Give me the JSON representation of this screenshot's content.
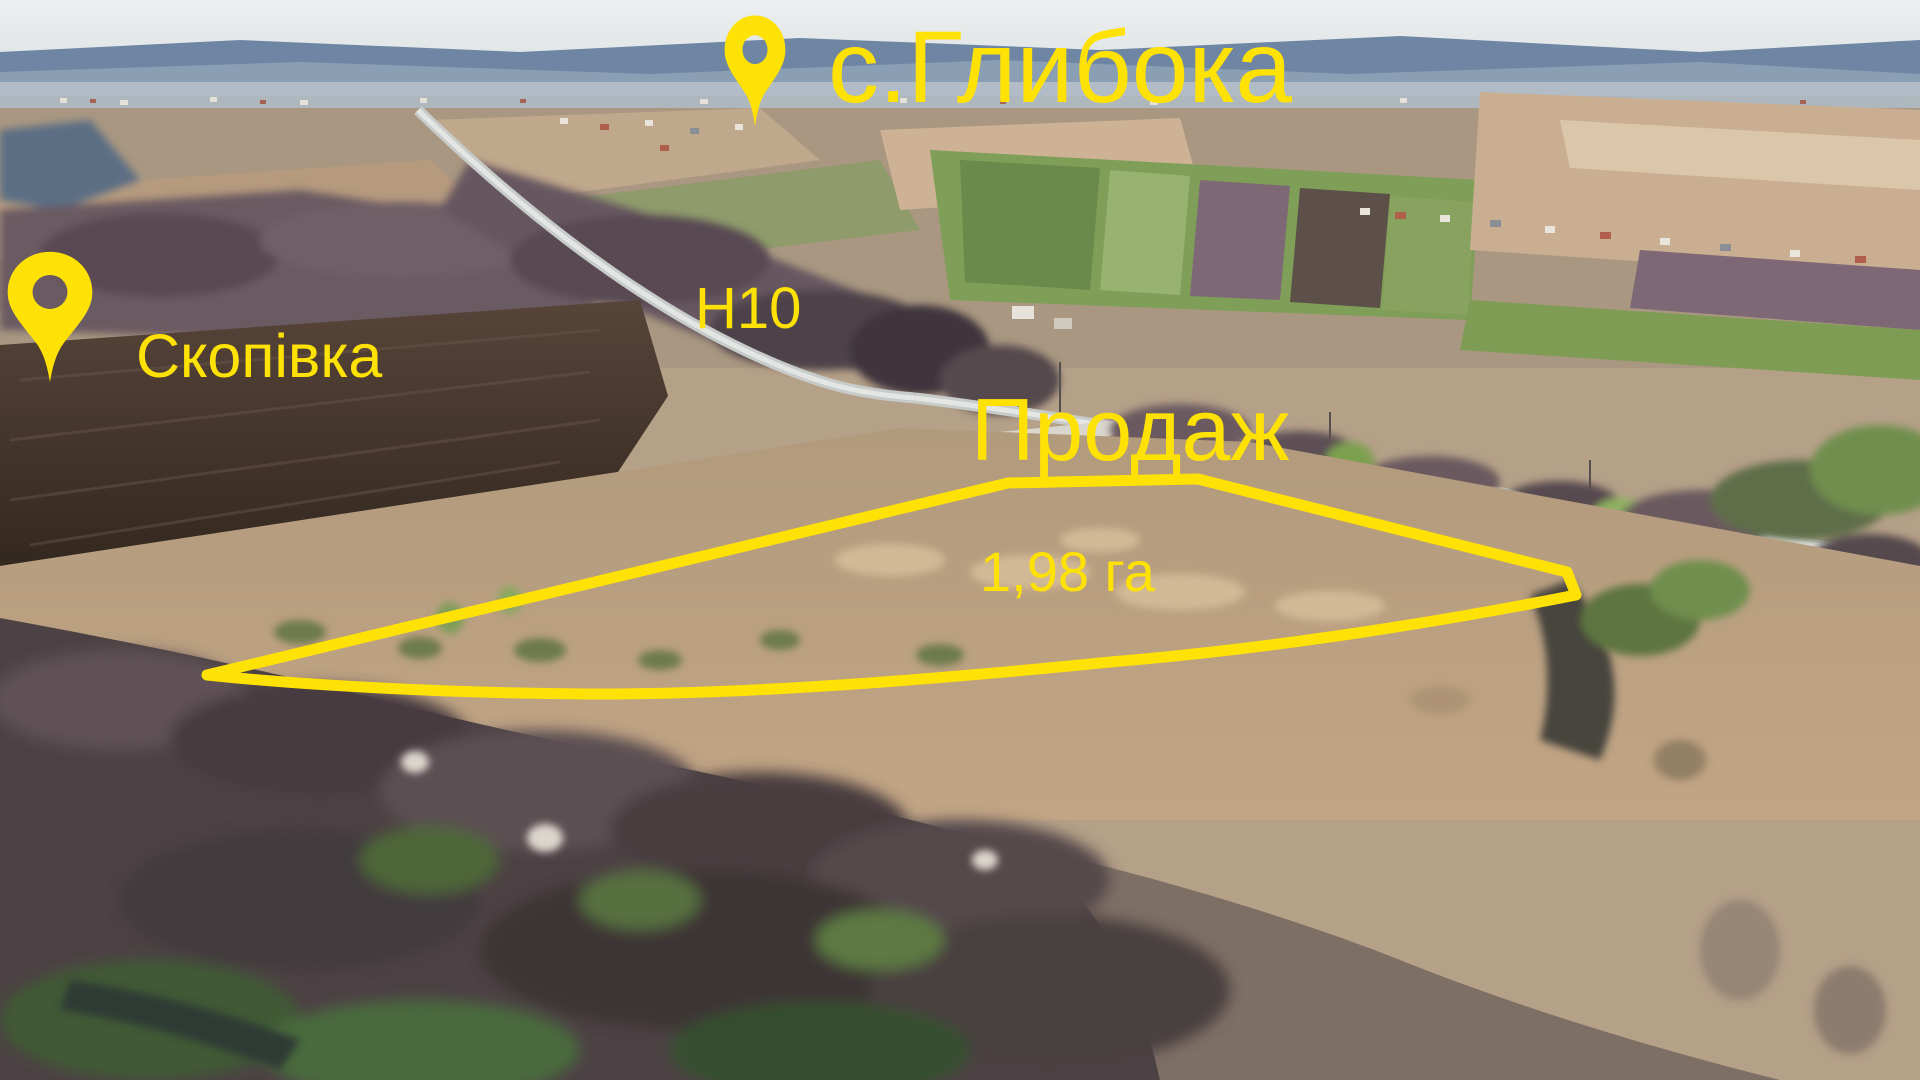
{
  "annotations": {
    "village_top": {
      "label": "с.Глибока"
    },
    "village_left": {
      "label": "Скопівка"
    },
    "road": {
      "label": "Н10"
    },
    "sale": {
      "label": "Продаж"
    },
    "area": {
      "label": "1,98 га"
    }
  },
  "icons": {
    "pin_top": "location-pin-icon",
    "pin_left": "location-pin-icon"
  },
  "colors": {
    "accent": "#FFE205",
    "sky": "#E6EAEB",
    "distant_hills": "#6E86A3",
    "field_tan": "#B59A7E",
    "field_green": "#7F9E58",
    "plowed_field": "#46362E",
    "forest": "#52464A",
    "road_surface": "#D8DAD8"
  }
}
